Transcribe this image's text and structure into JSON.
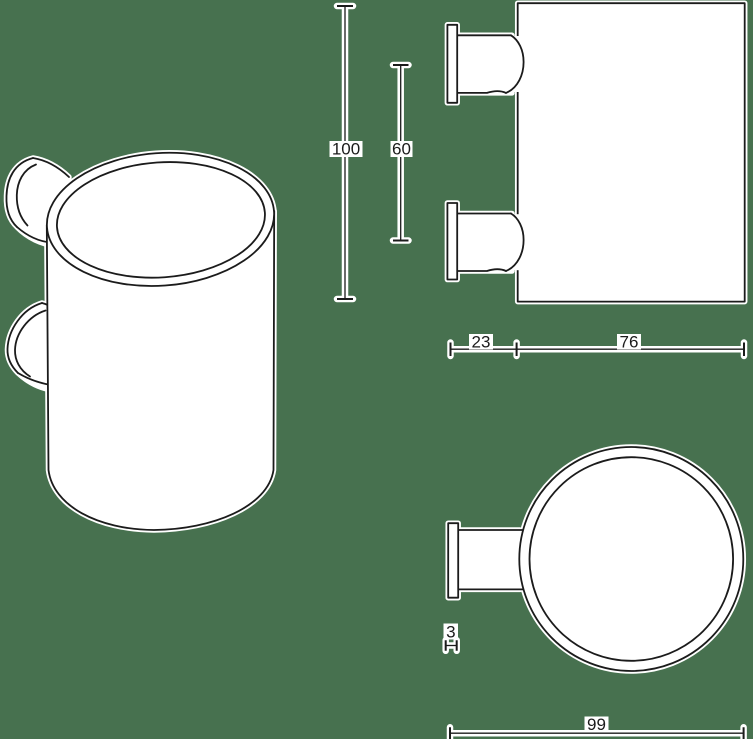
{
  "drawing": {
    "colors": {
      "background": "#47714f",
      "line": "#1b1b1b",
      "halo": "#ffffff"
    },
    "dimensions": {
      "cup_height": "100",
      "bracket_spacing": "60",
      "bracket_depth": "23",
      "cup_width": "76",
      "plate_thickness": "3",
      "overall_depth": "99"
    }
  }
}
